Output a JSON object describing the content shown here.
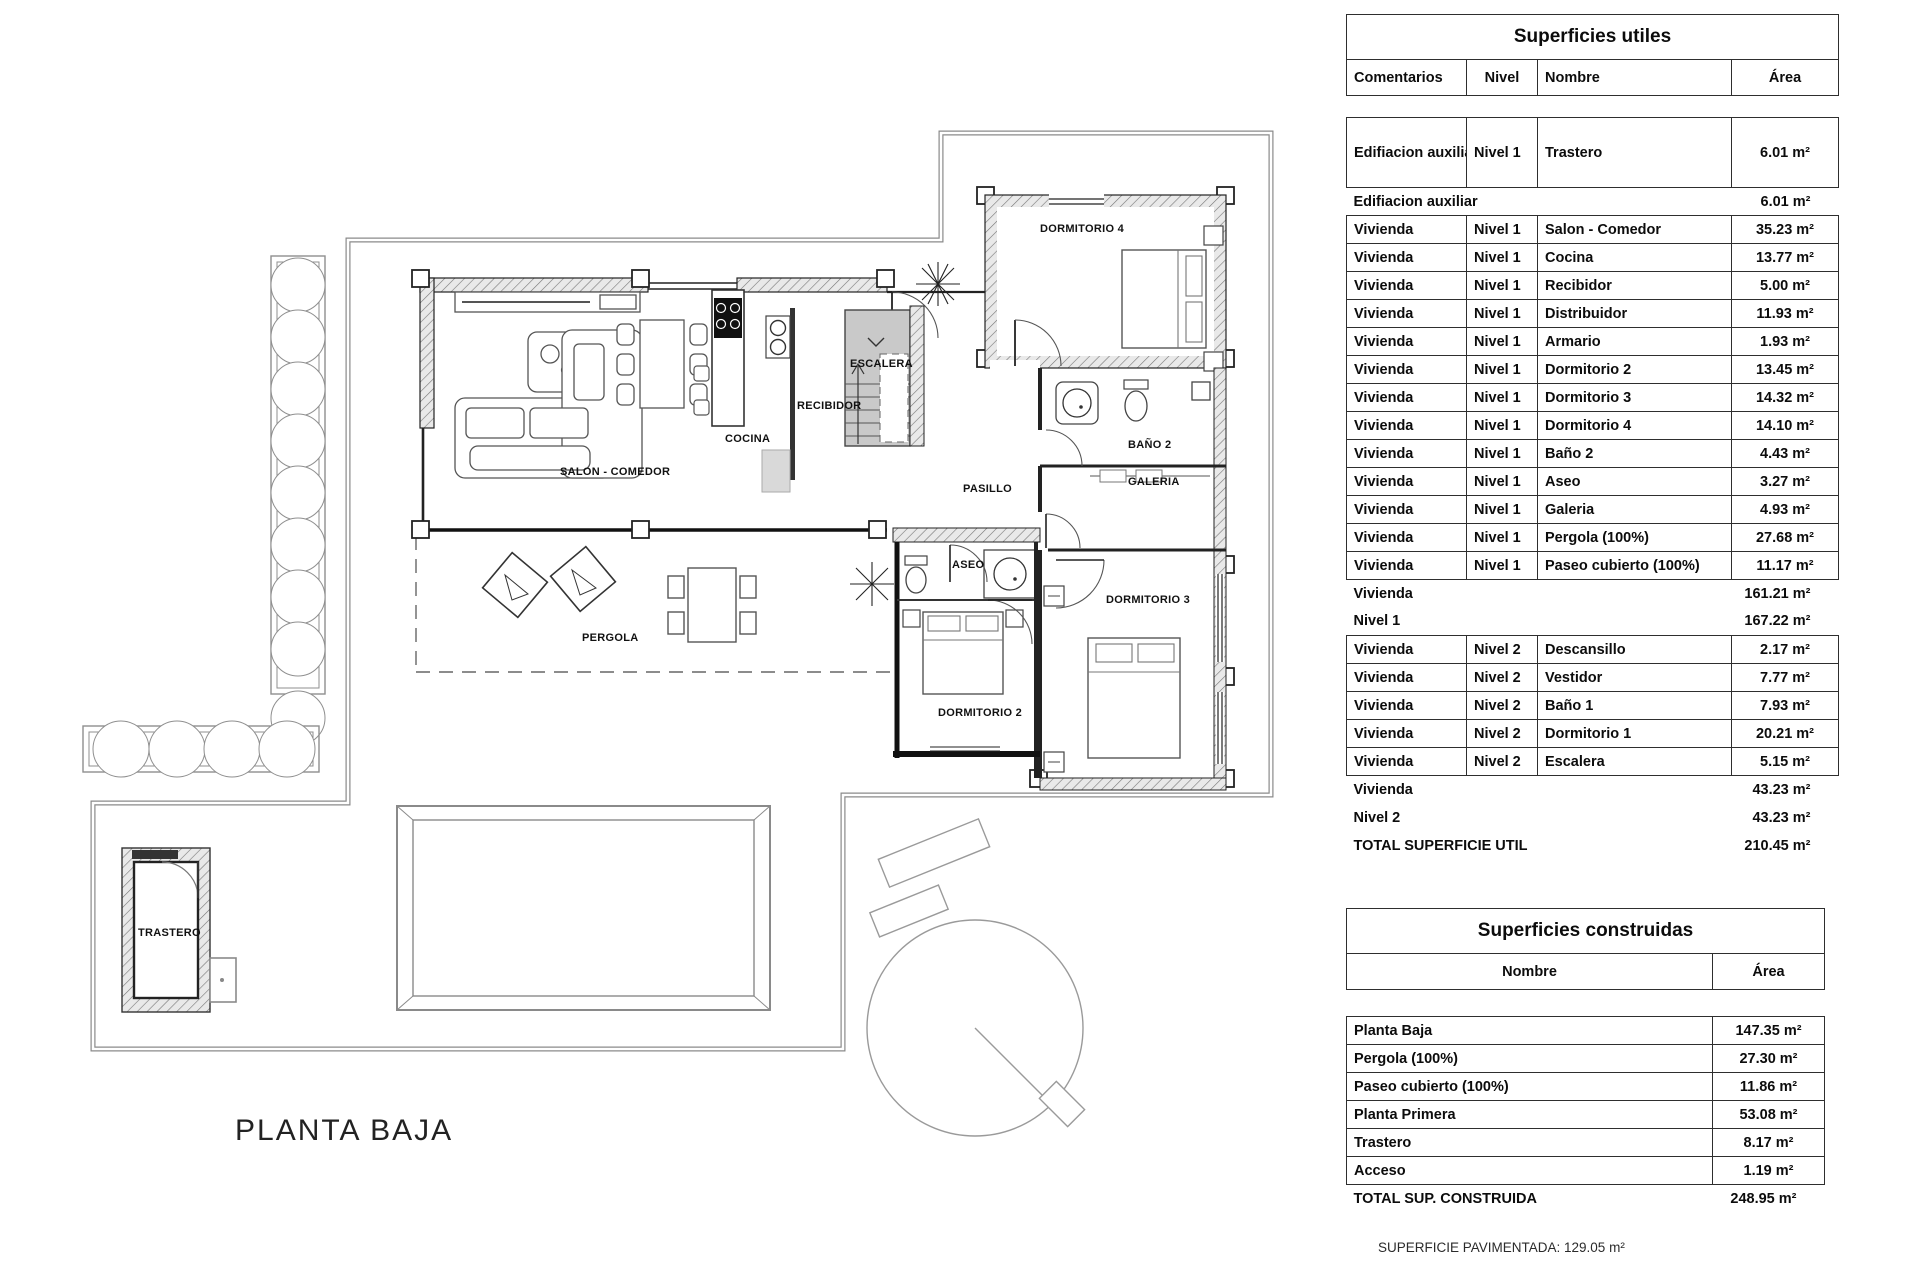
{
  "plan": {
    "floor_title": "PLANTA BAJA",
    "footnote": "SUPERFICIE PAVIMENTADA: 129.05 m²",
    "labels": {
      "salon": "SALON - COMEDOR",
      "cocina": "COCINA",
      "recibidor": "RECIBIDOR",
      "escalera": "ESCALERA",
      "pasillo": "PASILLO",
      "dormitorio4": "DORMITORIO 4",
      "bano2": "BAÑO 2",
      "galeria": "GALERIA",
      "aseo": "ASEO",
      "dormitorio3": "DORMITORIO 3",
      "dormitorio2": "DORMITORIO 2",
      "pergola": "PERGOLA",
      "trastero": "TRASTERO"
    }
  },
  "tables": {
    "utiles": {
      "title": "Superficies utiles",
      "headers": [
        "Comentarios",
        "Nivel",
        "Nombre",
        "Área"
      ],
      "rows": [
        {
          "type": "data",
          "comentarios": "Edifiacion auxiliar",
          "nivel": "Nivel 1",
          "nombre": "Trastero",
          "area": "6.01 m²",
          "tall": true
        },
        {
          "type": "subtotal",
          "label": "Edifiacion auxiliar",
          "area": "6.01 m²"
        },
        {
          "type": "data",
          "comentarios": "Vivienda",
          "nivel": "Nivel 1",
          "nombre": "Salon - Comedor",
          "area": "35.23 m²"
        },
        {
          "type": "data",
          "comentarios": "Vivienda",
          "nivel": "Nivel 1",
          "nombre": "Cocina",
          "area": "13.77 m²"
        },
        {
          "type": "data",
          "comentarios": "Vivienda",
          "nivel": "Nivel 1",
          "nombre": "Recibidor",
          "area": "5.00 m²"
        },
        {
          "type": "data",
          "comentarios": "Vivienda",
          "nivel": "Nivel 1",
          "nombre": "Distribuidor",
          "area": "11.93 m²"
        },
        {
          "type": "data",
          "comentarios": "Vivienda",
          "nivel": "Nivel 1",
          "nombre": "Armario",
          "area": "1.93 m²"
        },
        {
          "type": "data",
          "comentarios": "Vivienda",
          "nivel": "Nivel 1",
          "nombre": "Dormitorio 2",
          "area": "13.45 m²"
        },
        {
          "type": "data",
          "comentarios": "Vivienda",
          "nivel": "Nivel 1",
          "nombre": "Dormitorio 3",
          "area": "14.32 m²"
        },
        {
          "type": "data",
          "comentarios": "Vivienda",
          "nivel": "Nivel 1",
          "nombre": "Dormitorio 4",
          "area": "14.10 m²"
        },
        {
          "type": "data",
          "comentarios": "Vivienda",
          "nivel": "Nivel 1",
          "nombre": "Baño 2",
          "area": "4.43 m²"
        },
        {
          "type": "data",
          "comentarios": "Vivienda",
          "nivel": "Nivel 1",
          "nombre": "Aseo",
          "area": "3.27 m²"
        },
        {
          "type": "data",
          "comentarios": "Vivienda",
          "nivel": "Nivel 1",
          "nombre": "Galeria",
          "area": "4.93 m²"
        },
        {
          "type": "data",
          "comentarios": "Vivienda",
          "nivel": "Nivel 1",
          "nombre": "Pergola (100%)",
          "area": "27.68 m²"
        },
        {
          "type": "data",
          "comentarios": "Vivienda",
          "nivel": "Nivel 1",
          "nombre": "Paseo cubierto (100%)",
          "area": "11.17 m²"
        },
        {
          "type": "subtotal",
          "label": "Vivienda",
          "area": "161.21 m²"
        },
        {
          "type": "subtotal",
          "label": "Nivel 1",
          "area": "167.22 m²"
        },
        {
          "type": "data",
          "comentarios": "Vivienda",
          "nivel": "Nivel 2",
          "nombre": "Descansillo",
          "area": "2.17 m²"
        },
        {
          "type": "data",
          "comentarios": "Vivienda",
          "nivel": "Nivel 2",
          "nombre": "Vestidor",
          "area": "7.77 m²"
        },
        {
          "type": "data",
          "comentarios": "Vivienda",
          "nivel": "Nivel 2",
          "nombre": "Baño 1",
          "area": "7.93 m²"
        },
        {
          "type": "data",
          "comentarios": "Vivienda",
          "nivel": "Nivel 2",
          "nombre": "Dormitorio 1",
          "area": "20.21 m²"
        },
        {
          "type": "data",
          "comentarios": "Vivienda",
          "nivel": "Nivel 2",
          "nombre": "Escalera",
          "area": "5.15 m²"
        },
        {
          "type": "subtotal",
          "label": "Vivienda",
          "area": "43.23 m²"
        },
        {
          "type": "subtotal",
          "label": "Nivel 2",
          "area": "43.23 m²"
        },
        {
          "type": "total",
          "label": "TOTAL SUPERFICIE UTIL",
          "area": "210.45 m²"
        }
      ]
    },
    "construidas": {
      "title": "Superficies construidas",
      "headers": [
        "Nombre",
        "Área"
      ],
      "rows": [
        {
          "type": "data",
          "nombre": "Planta Baja",
          "area": "147.35 m²"
        },
        {
          "type": "data",
          "nombre": "Pergola (100%)",
          "area": "27.30 m²"
        },
        {
          "type": "data",
          "nombre": "Paseo cubierto (100%)",
          "area": "11.86 m²"
        },
        {
          "type": "data",
          "nombre": "Planta Primera",
          "area": "53.08 m²"
        },
        {
          "type": "data",
          "nombre": "Trastero",
          "area": "8.17 m²"
        },
        {
          "type": "data",
          "nombre": "Acceso",
          "area": "1.19 m²"
        },
        {
          "type": "total",
          "label": "TOTAL SUP. CONSTRUIDA",
          "area": "248.95 m²"
        }
      ]
    }
  }
}
